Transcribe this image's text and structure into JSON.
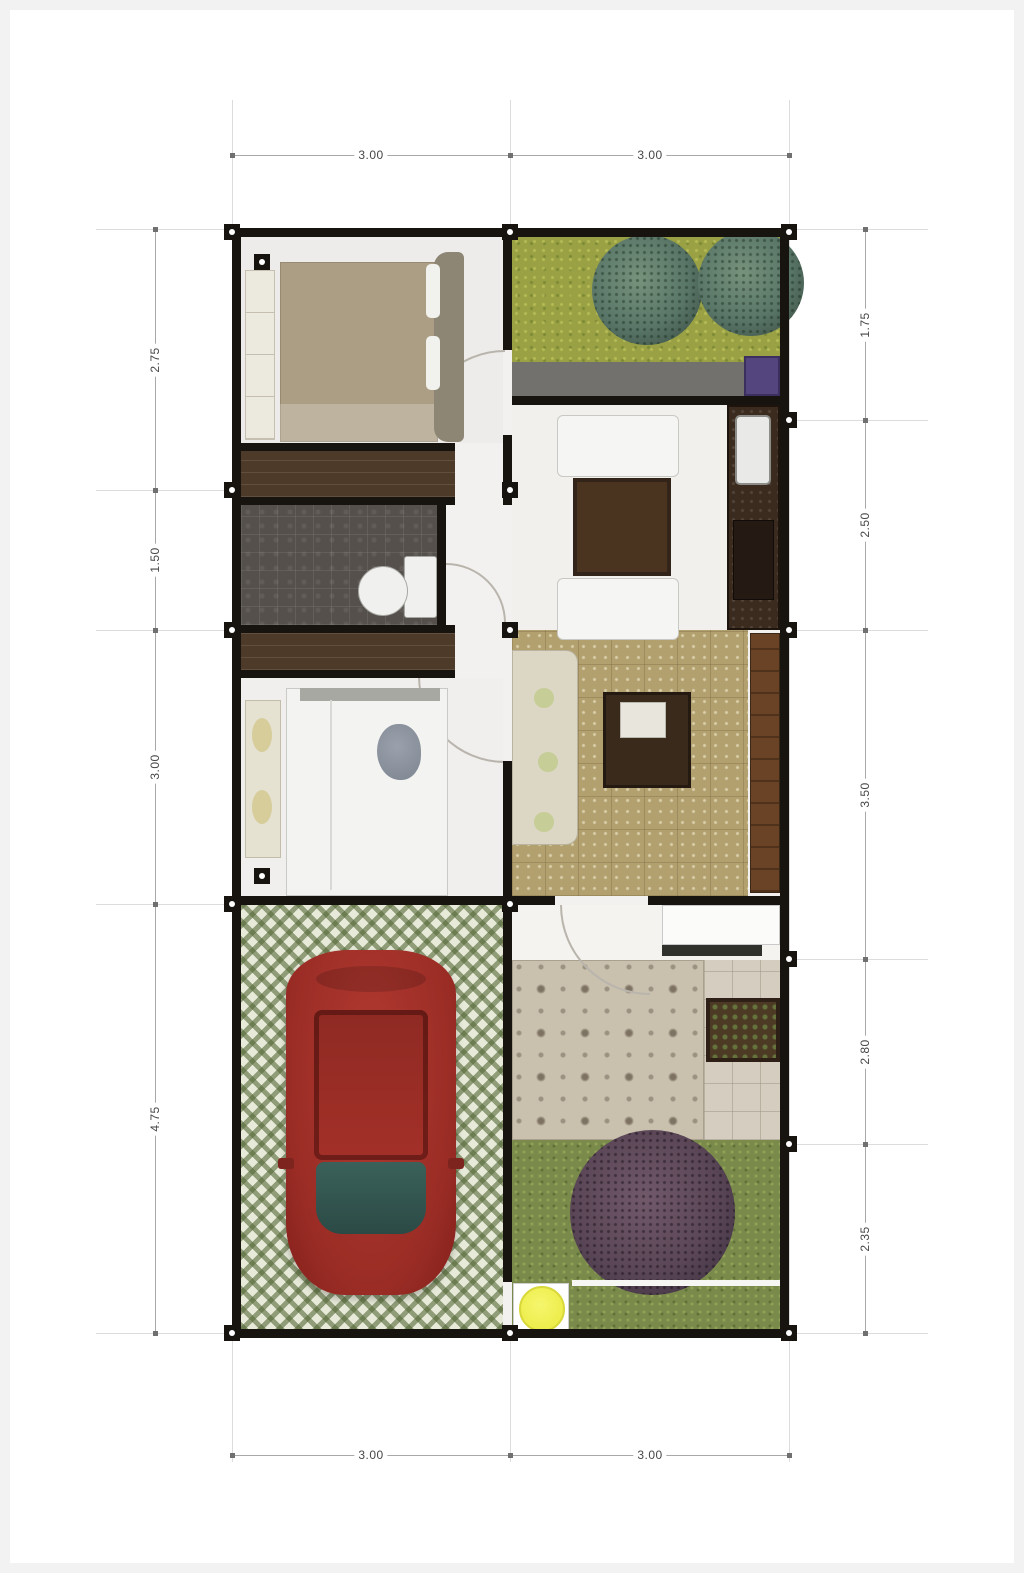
{
  "plan": {
    "type": "house-floor-plan",
    "units_shown": false
  },
  "dims": {
    "top": [
      "3.00",
      "3.00"
    ],
    "bottom": [
      "3.00",
      "3.00"
    ],
    "left": [
      "2.75",
      "1.50",
      "3.00",
      "4.75"
    ],
    "right": [
      "1.75",
      "2.50",
      "3.50",
      "2.80",
      "2.35"
    ]
  },
  "colors": {
    "wall": "#17130f",
    "grass_top": "#99a144",
    "grass_bottom": "#798a4a",
    "tree_top": "#587567",
    "tree_bottom": "#5a4656",
    "car_body": "#9c2d26",
    "windshield": "#335c55",
    "carport_paver_green": "#5a6937",
    "bathroom_tile": "#55504b",
    "wood_cabinet": "#4e3a28",
    "living_rug": "#b2a06f",
    "terrace_tile": "#c9c0ae",
    "accent_yellow": "#eded4d",
    "dimension_line": "#a8a8a8",
    "dimension_text": "#474747"
  }
}
